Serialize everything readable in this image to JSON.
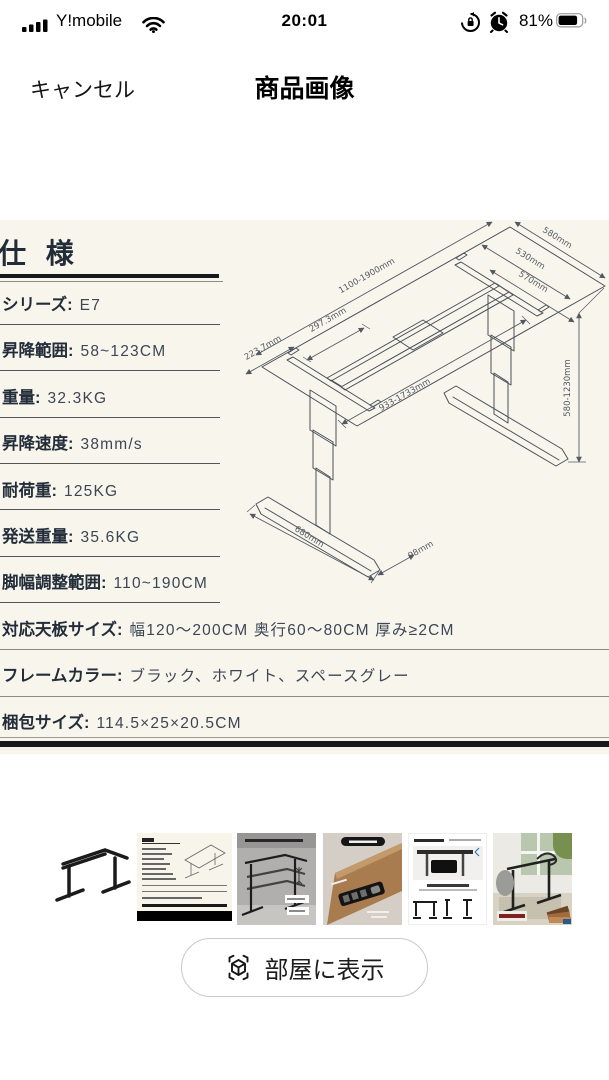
{
  "status_bar": {
    "carrier": "Y!mobile",
    "time": "20:01",
    "battery_percent": "81%",
    "icons": [
      "signal-icon",
      "wifi-icon",
      "rotation-lock-icon",
      "alarm-icon",
      "battery-icon"
    ]
  },
  "nav": {
    "cancel_label": "キャンセル",
    "title": "商品画像"
  },
  "spec_sheet": {
    "heading": "仕 様",
    "background_color": "#f8f6ec",
    "text_color": "#232d3a",
    "rows": [
      {
        "label": "シリーズ:",
        "value": "E7"
      },
      {
        "label": "昇降範囲:",
        "value": "58~123CM"
      },
      {
        "label": "重量:",
        "value": "32.3KG"
      },
      {
        "label": "昇降速度:",
        "value": "38mm/s"
      },
      {
        "label": "耐荷重:",
        "value": "125KG"
      },
      {
        "label": "発送重量:",
        "value": "35.6KG"
      },
      {
        "label": "脚幅調整範囲:",
        "value": "110~190CM"
      },
      {
        "label": "対応天板サイズ:",
        "value": "幅120〜200CM 奥行60〜80CM 厚み≥2CM"
      },
      {
        "label": "フレームカラー:",
        "value": "ブラック、ホワイト、スペースグレー"
      },
      {
        "label": "梱包サイズ:",
        "value": "114.5×25×20.5CM"
      }
    ]
  },
  "drawing": {
    "dims": {
      "top_length": "1100-1900mm",
      "beam_inset": "297.3mm",
      "side_inset": "223.7mm",
      "top_depth": "580mm",
      "bracket_length": "530mm",
      "crossbar_length": "570mm",
      "rail_range": "933-1733mm",
      "height_range": "580-1230mm",
      "foot_length": "680mm",
      "foot_width": "98mm"
    }
  },
  "thumbnails": [
    {
      "name": "black-frame-photo"
    },
    {
      "name": "spec-sheet-image",
      "selected": true
    },
    {
      "name": "height-adjust-photo"
    },
    {
      "name": "touch-panel-photo"
    },
    {
      "name": "dual-motor-diagram"
    },
    {
      "name": "room-scene-photo"
    }
  ],
  "ar_button": {
    "label": "部屋に表示"
  }
}
